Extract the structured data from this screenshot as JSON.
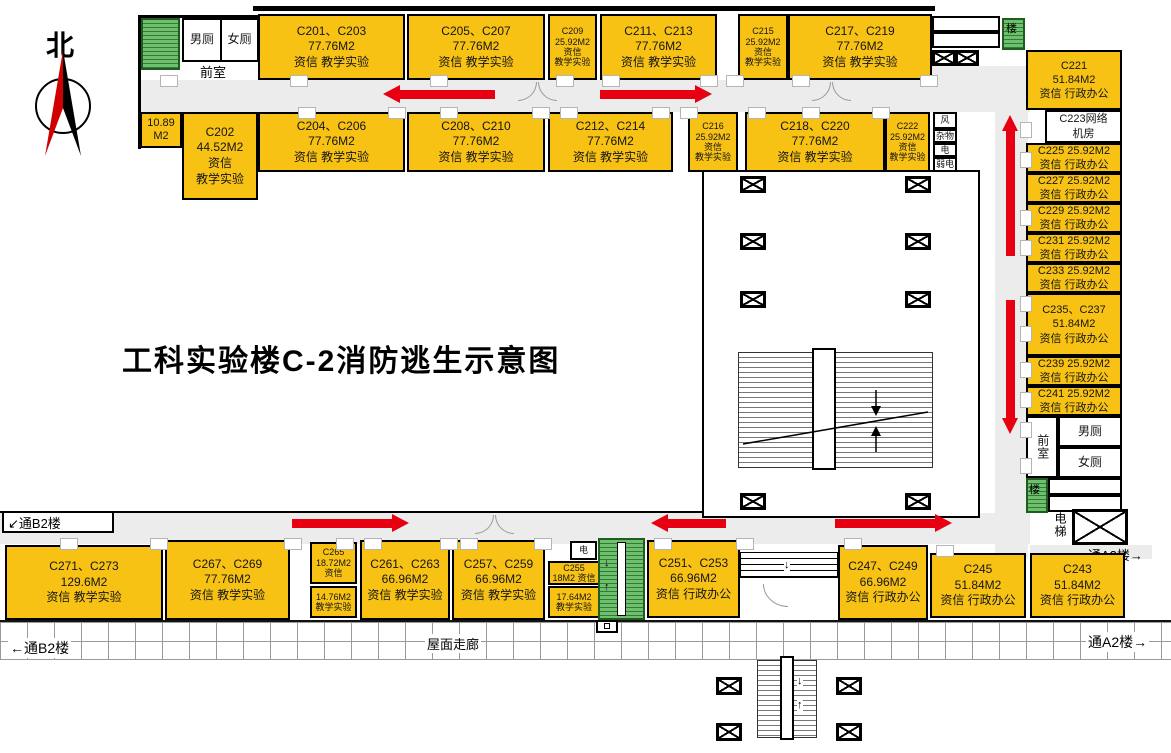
{
  "title": "工科实验楼C-2消防逃生示意图",
  "compass_label": "北",
  "colors": {
    "room_fill": "#F7C214",
    "stair_fill": "#6FBF6F",
    "escape_arrow": "#E60012",
    "corridor": "#ECECEC"
  },
  "nav": {
    "to_b2_upper": "↙通B2楼",
    "to_b2_lower": "←通B2楼",
    "to_a2_mid": "通A2楼→",
    "to_a2_lower": "通A2楼→",
    "roof_corridor": "屋面走廊"
  },
  "stair_labels": {
    "upper_right": "楼",
    "lower_right": "楼"
  },
  "elevator_label": "电梯",
  "stair_arrows": {
    "down": "↓",
    "up": "↑"
  },
  "rooms": {
    "wc_men_top": "男厕",
    "wc_women_top": "女厕",
    "front_top": "前室",
    "r10_89": "10.89\nM2",
    "c202": "C202\n44.52M2\n资信\n教学实验",
    "c201_203": "C201、C203\n77.76M2\n资信 教学实验",
    "c205_207": "C205、C207\n77.76M2\n资信 教学实验",
    "c209": "C209\n25.92M2\n资信\n教学实验",
    "c211_213": "C211、C213\n77.76M2\n资信 教学实验",
    "c215": "C215\n25.92M2\n资信\n教学实验",
    "c217_219": "C217、C219\n77.76M2\n资信 教学实验",
    "c204_206": "C204、C206\n77.76M2\n资信 教学实验",
    "c208_210": "C208、C210\n77.76M2\n资信 教学实验",
    "c212_214": "C212、C214\n77.76M2\n资信 教学实验",
    "c216": "C216\n25.92M2\n资信\n教学实验",
    "c218_220": "C218、C220\n77.76M2\n资信 教学实验",
    "c222": "C222\n25.92M2\n资信\n教学实验",
    "util_feng": "风",
    "util_zawu": "杂物",
    "util_dian": "电",
    "util_ruodian": "弱电",
    "c221": "C221\n51.84M2\n资信 行政办公",
    "c223": "C223网络\n机房",
    "c225": "C225 25.92M2\n资信 行政办公",
    "c227": "C227 25.92M2\n资信 行政办公",
    "c229": "C229 25.92M2\n资信 行政办公",
    "c231": "C231 25.92M2\n资信 行政办公",
    "c233": "C233 25.92M2\n资信 行政办公",
    "c235_237": "C235、C237\n51.84M2\n资信 行政办公",
    "c239": "C239 25.92M2\n资信 行政办公",
    "c241": "C241 25.92M2\n资信 行政办公",
    "front_right": "前室",
    "wc_men_right": "男厕",
    "wc_women_right": "女厕",
    "c243": "C243\n51.84M2\n资信 行政办公",
    "c245": "C245\n51.84M2\n资信 行政办公",
    "c247_249": "C247、C249\n66.96M2\n资信 行政办公",
    "c251_253": "C251、C253\n66.96M2\n资信 行政办公",
    "c255": "C255\n18M2 资信",
    "r17_64": "17.64M2\n教学实验",
    "elec_bottom": "电",
    "c257_259": "C257、C259\n66.96M2\n资信 教学实验",
    "c261_263": "C261、C263\n66.96M2\n资信 教学实验",
    "c265": "C265\n18.72M2\n资信",
    "r14_76": "14.76M2\n教学实验",
    "c267_269": "C267、C269\n77.76M2\n资信 教学实验",
    "c271_273": "C271、C273\n129.6M2\n资信 教学实验"
  }
}
